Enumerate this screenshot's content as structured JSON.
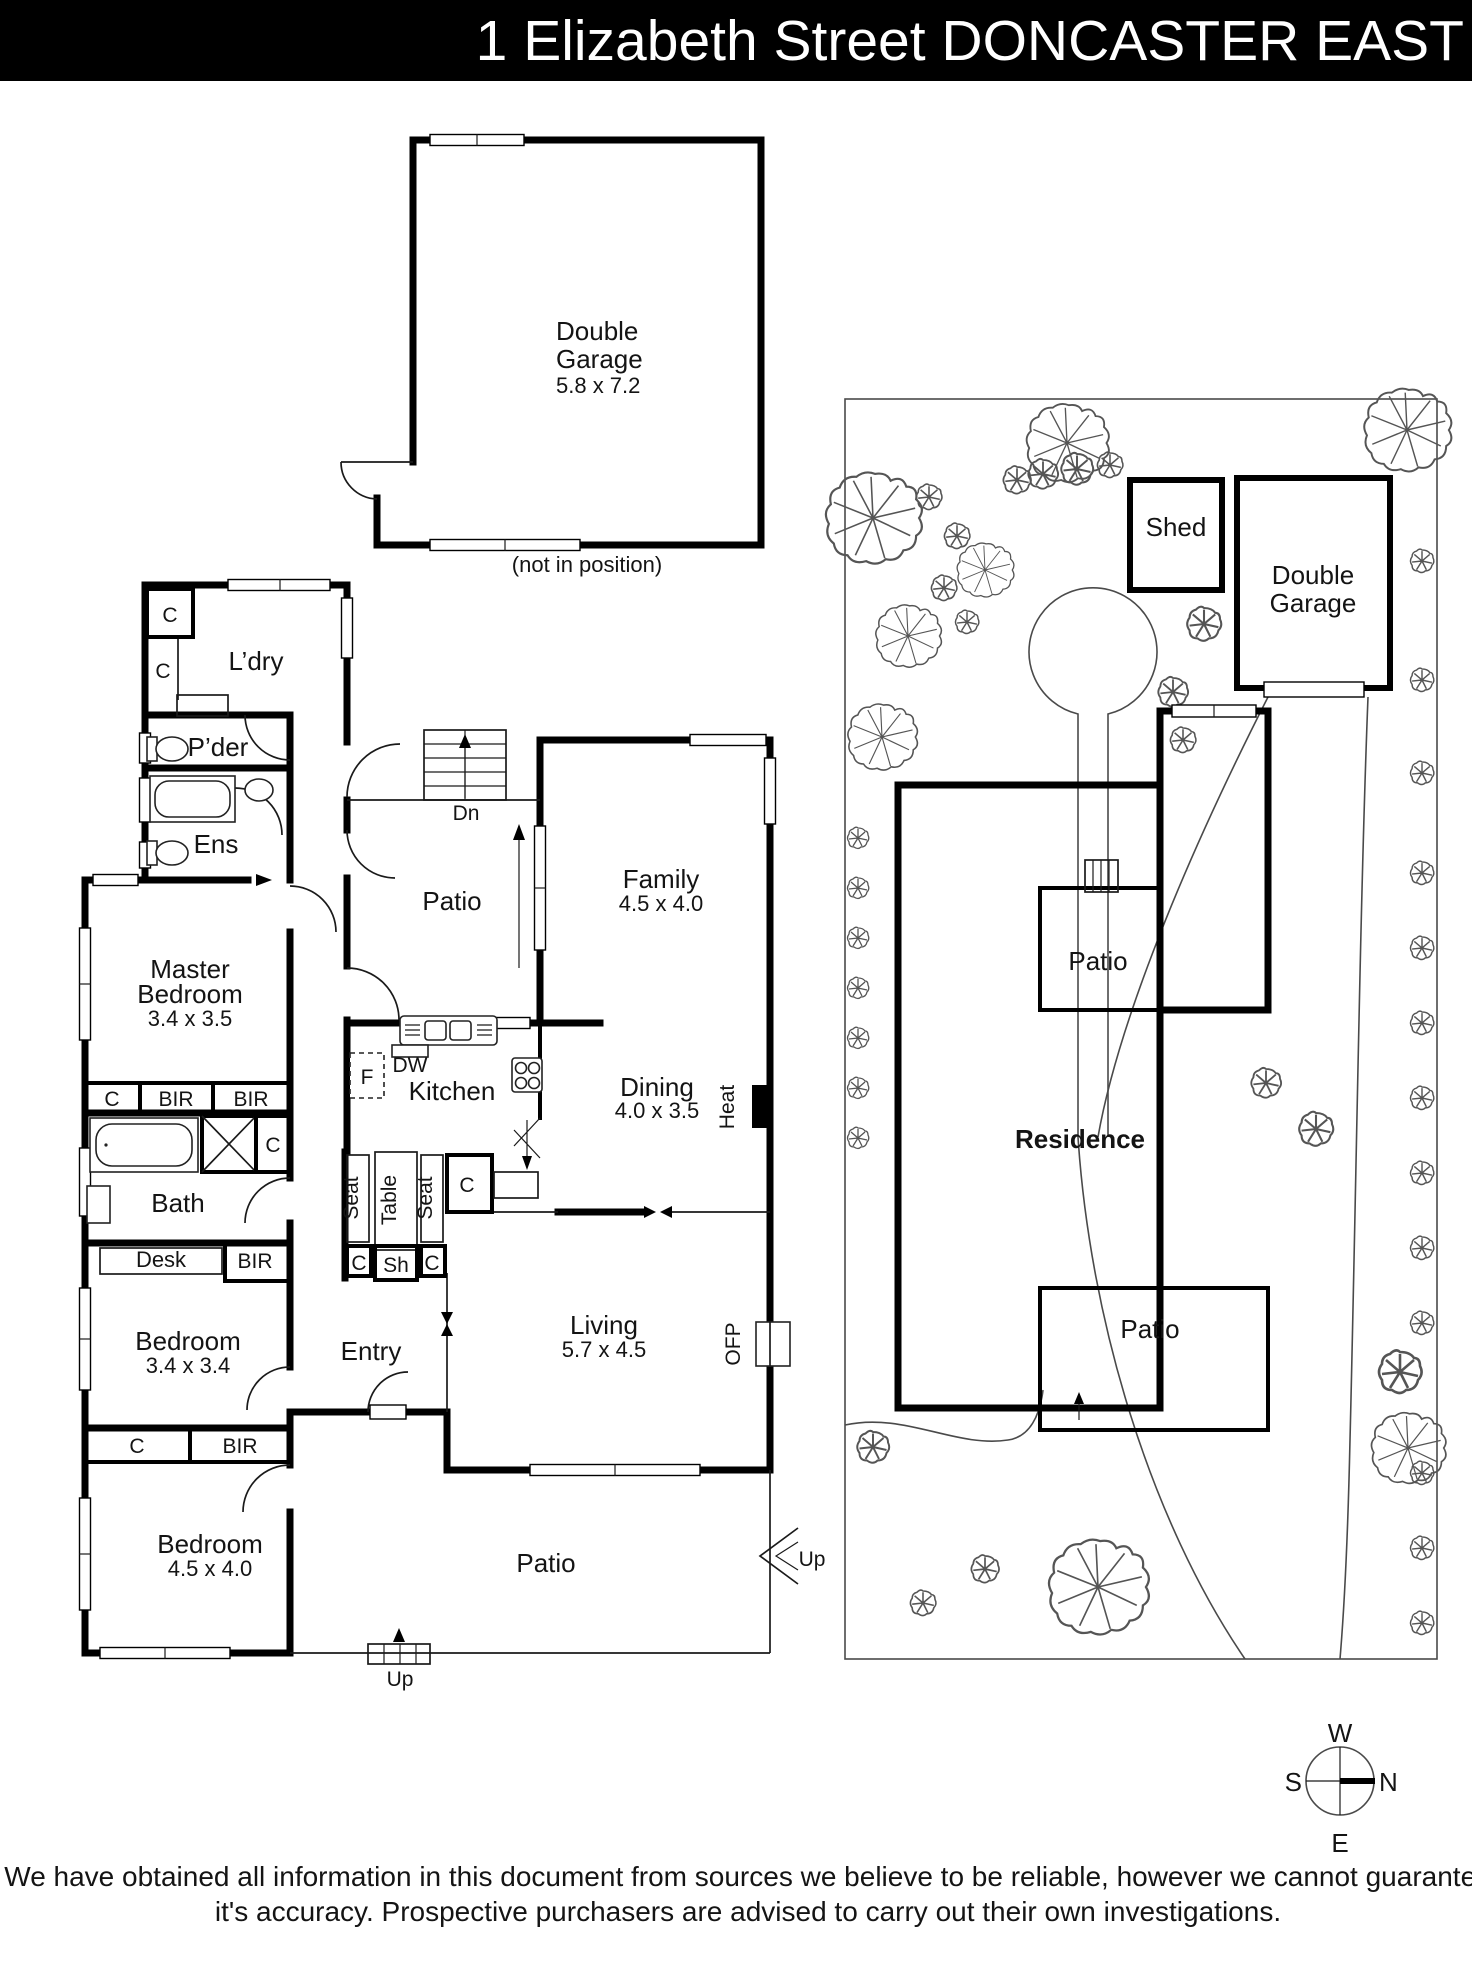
{
  "header": {
    "title": "1 Elizabeth Street DONCASTER EAST"
  },
  "garage_plan": {
    "label_line1": "Double",
    "label_line2": "Garage",
    "dims": "5.8 x 7.2",
    "note": "(not in position)"
  },
  "floor_plan": {
    "laundry": "L’dry",
    "powder": "P’der",
    "ensuite": "Ens",
    "master_line1": "Master",
    "master_line2": "Bedroom",
    "master_dims": "3.4 x 3.5",
    "family": "Family",
    "family_dims": "4.5 x 4.0",
    "dining": "Dining",
    "dining_dims": "4.0 x 3.5",
    "living": "Living",
    "living_dims": "5.7 x 4.5",
    "bedroom2": "Bedroom",
    "bedroom2_dims": "3.4 x 3.4",
    "bedroom3": "Bedroom",
    "bedroom3_dims": "4.5 x 4.0",
    "kitchen": "Kitchen",
    "bath": "Bath",
    "entry": "Entry",
    "patio_upper": "Patio",
    "patio_lower": "Patio",
    "stairs_down": "Dn",
    "up_side": "Up",
    "up_bottom": "Up",
    "heater": "Heat",
    "fireplace": "OFP",
    "fridge": "F",
    "dishwasher": "DW",
    "desk": "Desk",
    "closet": "C",
    "robe": "BIR",
    "shelves": "Sh",
    "seat": "Seat",
    "table": "Table"
  },
  "site_plan": {
    "shed": "Shed",
    "garage_line1": "Double",
    "garage_line2": "Garage",
    "residence": "Residence",
    "patio_upper": "Patio",
    "patio_lower": "Patio"
  },
  "compass": {
    "north": "N",
    "south": "S",
    "east": "E",
    "west": "W"
  },
  "disclaimer": {
    "line1": "We have obtained all information in this document from sources we believe to be reliable, however we cannot guarantee",
    "line2": "it's accuracy. Prospective purchasers are advised to carry out their own investigations."
  }
}
